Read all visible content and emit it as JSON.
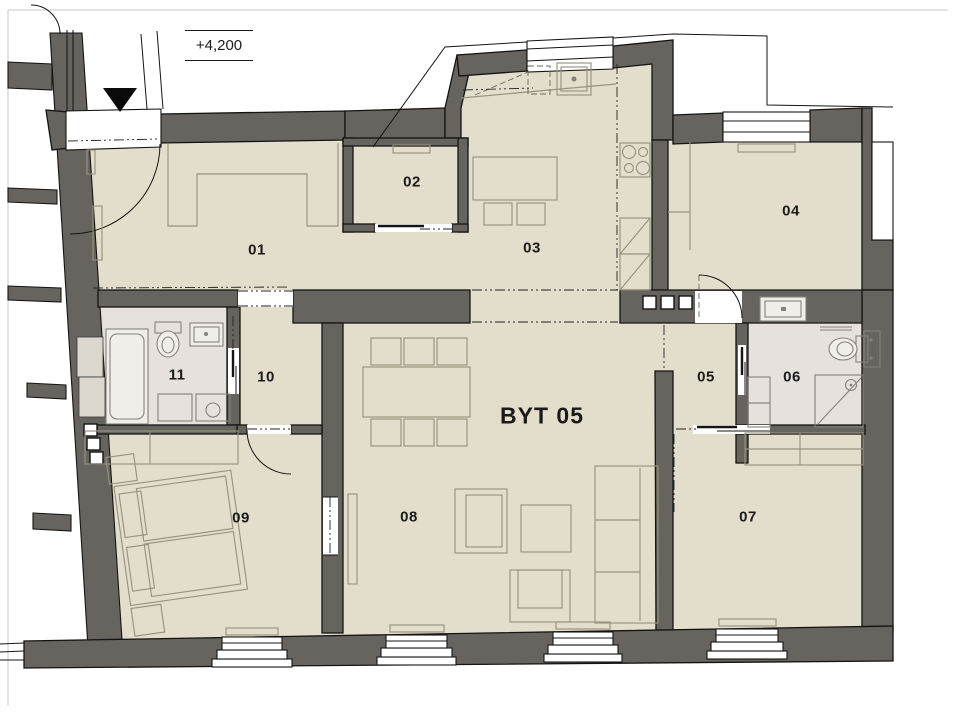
{
  "title": "Apartment floor plan",
  "colors": {
    "wall": "#67645f",
    "floor": "#e3decb",
    "bath": "#e6e1dd",
    "furniture": "#98937d",
    "page_border": "#c9c9c9"
  },
  "elevation_label": "+4,200",
  "apartment_label": "BYT 05",
  "apartment_label_pos": {
    "x": 542,
    "y": 416
  },
  "rooms": [
    {
      "number": "01",
      "x": 257,
      "y": 250
    },
    {
      "number": "02",
      "x": 412,
      "y": 182
    },
    {
      "number": "03",
      "x": 532,
      "y": 248
    },
    {
      "number": "04",
      "x": 791,
      "y": 211
    },
    {
      "number": "05",
      "x": 706,
      "y": 377
    },
    {
      "number": "06",
      "x": 792,
      "y": 377
    },
    {
      "number": "07",
      "x": 748,
      "y": 517
    },
    {
      "number": "08",
      "x": 409,
      "y": 517
    },
    {
      "number": "09",
      "x": 241,
      "y": 518
    },
    {
      "number": "10",
      "x": 266,
      "y": 377
    },
    {
      "number": "11",
      "x": 177,
      "y": 375
    }
  ]
}
